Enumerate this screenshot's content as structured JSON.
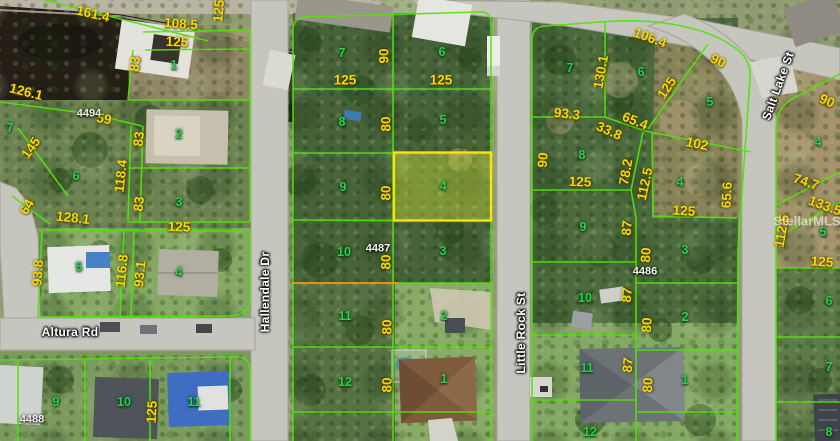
{
  "map_type": "aerial-parcel-plat",
  "highlighted_lot": "4",
  "colors": {
    "parcel_line": "#52e408",
    "highlight_line": "#ffe400",
    "dimension_text": "#f4da06",
    "lot_text": "#2ccf4d"
  },
  "streets": [
    {
      "t": "Hallendale Dr",
      "x": 265,
      "y": 292,
      "r": -90
    },
    {
      "t": "Little Rock St",
      "x": 521,
      "y": 333,
      "r": -90
    },
    {
      "t": "Salt Lake St",
      "x": 778,
      "y": 86,
      "r": -70
    },
    {
      "t": "Altura Rd",
      "x": 70,
      "y": 332,
      "r": 0
    }
  ],
  "dimensions": [
    {
      "t": "161.4",
      "x": 93,
      "y": 14,
      "r": 13
    },
    {
      "t": "108.5",
      "x": 181,
      "y": 24,
      "r": 4
    },
    {
      "t": "125",
      "x": 177,
      "y": 42,
      "r": 2
    },
    {
      "t": "83",
      "x": 135,
      "y": 64,
      "r": -84
    },
    {
      "t": "126.1",
      "x": 26,
      "y": 92,
      "r": 14
    },
    {
      "t": "59",
      "x": 104,
      "y": 119,
      "r": 10
    },
    {
      "t": "145",
      "x": 31,
      "y": 148,
      "r": -55
    },
    {
      "t": "83",
      "x": 139,
      "y": 139,
      "r": -84
    },
    {
      "t": "118.4",
      "x": 121,
      "y": 176,
      "r": -84
    },
    {
      "t": "83",
      "x": 139,
      "y": 204,
      "r": -84
    },
    {
      "t": "64",
      "x": 27,
      "y": 207,
      "r": -58
    },
    {
      "t": "128.1",
      "x": 73,
      "y": 218,
      "r": 6
    },
    {
      "t": "125",
      "x": 179,
      "y": 227,
      "r": 2
    },
    {
      "t": "93.8",
      "x": 38,
      "y": 273,
      "r": -86
    },
    {
      "t": "116.8",
      "x": 122,
      "y": 271,
      "r": -84
    },
    {
      "t": "93.1",
      "x": 140,
      "y": 274,
      "r": -84
    },
    {
      "t": "125",
      "x": 152,
      "y": 412,
      "r": -87
    },
    {
      "t": "125",
      "x": 219,
      "y": 11,
      "r": -85
    },
    {
      "t": "125",
      "x": 345,
      "y": 80,
      "r": 0
    },
    {
      "t": "125",
      "x": 441,
      "y": 80,
      "r": 0
    },
    {
      "t": "90",
      "x": 384,
      "y": 56,
      "r": -90
    },
    {
      "t": "80",
      "x": 386,
      "y": 124,
      "r": -90
    },
    {
      "t": "80",
      "x": 386,
      "y": 193,
      "r": -90
    },
    {
      "t": "80",
      "x": 386,
      "y": 262,
      "r": -90
    },
    {
      "t": "80",
      "x": 387,
      "y": 327,
      "r": -90
    },
    {
      "t": "80",
      "x": 387,
      "y": 385,
      "r": -90
    },
    {
      "t": "106.4",
      "x": 650,
      "y": 38,
      "r": 20
    },
    {
      "t": "90",
      "x": 718,
      "y": 61,
      "r": 26
    },
    {
      "t": "130.1",
      "x": 601,
      "y": 72,
      "r": -80
    },
    {
      "t": "125",
      "x": 667,
      "y": 88,
      "r": -56
    },
    {
      "t": "93.3",
      "x": 567,
      "y": 114,
      "r": 6
    },
    {
      "t": "65.4",
      "x": 635,
      "y": 121,
      "r": 22
    },
    {
      "t": "33.8",
      "x": 609,
      "y": 131,
      "r": 24
    },
    {
      "t": "102",
      "x": 697,
      "y": 144,
      "r": 12
    },
    {
      "t": "90",
      "x": 543,
      "y": 160,
      "r": -85
    },
    {
      "t": "78.2",
      "x": 626,
      "y": 172,
      "r": -80
    },
    {
      "t": "112.5",
      "x": 645,
      "y": 184,
      "r": -78
    },
    {
      "t": "125",
      "x": 580,
      "y": 182,
      "r": 2
    },
    {
      "t": "125",
      "x": 684,
      "y": 211,
      "r": 3
    },
    {
      "t": "65.6",
      "x": 727,
      "y": 195,
      "r": -87
    },
    {
      "t": "87",
      "x": 627,
      "y": 228,
      "r": -85
    },
    {
      "t": "80",
      "x": 646,
      "y": 255,
      "r": -87
    },
    {
      "t": "87",
      "x": 627,
      "y": 295,
      "r": -85
    },
    {
      "t": "80",
      "x": 647,
      "y": 325,
      "r": -87
    },
    {
      "t": "87",
      "x": 628,
      "y": 365,
      "r": -85
    },
    {
      "t": "80",
      "x": 648,
      "y": 385,
      "r": -87
    },
    {
      "t": "90",
      "x": 827,
      "y": 101,
      "r": 24
    },
    {
      "t": "74.7",
      "x": 806,
      "y": 182,
      "r": 18
    },
    {
      "t": "133.5",
      "x": 825,
      "y": 206,
      "r": 20
    },
    {
      "t": "112.5",
      "x": 782,
      "y": 231,
      "r": -80
    },
    {
      "t": "125",
      "x": 822,
      "y": 262,
      "r": 4
    }
  ],
  "lot_numbers": [
    {
      "t": "1",
      "x": 174,
      "y": 65
    },
    {
      "t": "2",
      "x": 179,
      "y": 134
    },
    {
      "t": "3",
      "x": 179,
      "y": 202
    },
    {
      "t": "7",
      "x": 10,
      "y": 128
    },
    {
      "t": "6",
      "x": 76,
      "y": 176
    },
    {
      "t": "5",
      "x": 79,
      "y": 267
    },
    {
      "t": "4",
      "x": 179,
      "y": 272
    },
    {
      "t": "9",
      "x": 56,
      "y": 402
    },
    {
      "t": "10",
      "x": 124,
      "y": 402
    },
    {
      "t": "11",
      "x": 194,
      "y": 402
    },
    {
      "t": "7",
      "x": 342,
      "y": 53
    },
    {
      "t": "6",
      "x": 442,
      "y": 52
    },
    {
      "t": "8",
      "x": 342,
      "y": 122
    },
    {
      "t": "5",
      "x": 443,
      "y": 120
    },
    {
      "t": "9",
      "x": 343,
      "y": 187
    },
    {
      "t": "4",
      "x": 443,
      "y": 186
    },
    {
      "t": "10",
      "x": 344,
      "y": 252
    },
    {
      "t": "3",
      "x": 443,
      "y": 251
    },
    {
      "t": "11",
      "x": 345,
      "y": 316
    },
    {
      "t": "2",
      "x": 444,
      "y": 316
    },
    {
      "t": "12",
      "x": 345,
      "y": 382
    },
    {
      "t": "1",
      "x": 444,
      "y": 379
    },
    {
      "t": "7",
      "x": 570,
      "y": 68
    },
    {
      "t": "6",
      "x": 641,
      "y": 72
    },
    {
      "t": "5",
      "x": 710,
      "y": 102
    },
    {
      "t": "8",
      "x": 582,
      "y": 155
    },
    {
      "t": "4",
      "x": 680,
      "y": 182
    },
    {
      "t": "9",
      "x": 583,
      "y": 227
    },
    {
      "t": "3",
      "x": 685,
      "y": 250
    },
    {
      "t": "10",
      "x": 585,
      "y": 298
    },
    {
      "t": "2",
      "x": 685,
      "y": 317
    },
    {
      "t": "11",
      "x": 587,
      "y": 368
    },
    {
      "t": "1",
      "x": 685,
      "y": 380
    },
    {
      "t": "12",
      "x": 590,
      "y": 432
    },
    {
      "t": "4",
      "x": 818,
      "y": 142
    },
    {
      "t": "5",
      "x": 823,
      "y": 232
    },
    {
      "t": "6",
      "x": 829,
      "y": 301
    },
    {
      "t": "7",
      "x": 829,
      "y": 367
    },
    {
      "t": "8",
      "x": 829,
      "y": 432
    }
  ],
  "block_numbers": [
    {
      "t": "4494",
      "x": 89,
      "y": 114
    },
    {
      "t": "4487",
      "x": 378,
      "y": 249
    },
    {
      "t": "4486",
      "x": 645,
      "y": 272
    },
    {
      "t": "4488",
      "x": 32,
      "y": 420
    }
  ],
  "watermark": {
    "t": "StellarMLS",
    "x": 807,
    "y": 221
  }
}
